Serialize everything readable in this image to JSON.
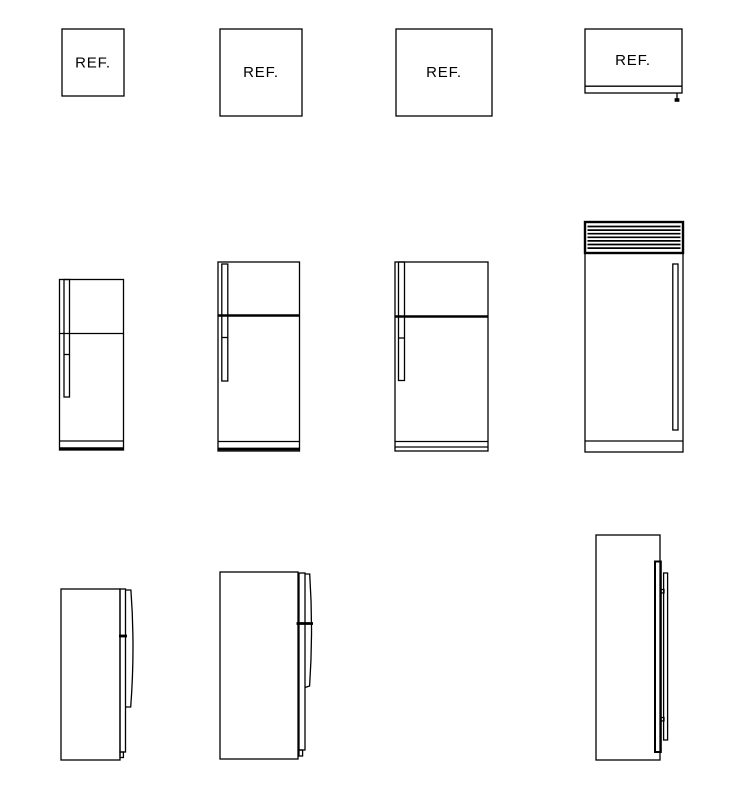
{
  "drawing": {
    "background_color": "#ffffff",
    "line_color": "#000000",
    "plan_labels": [
      "REF.",
      "REF.",
      "REF.",
      "REF."
    ]
  }
}
